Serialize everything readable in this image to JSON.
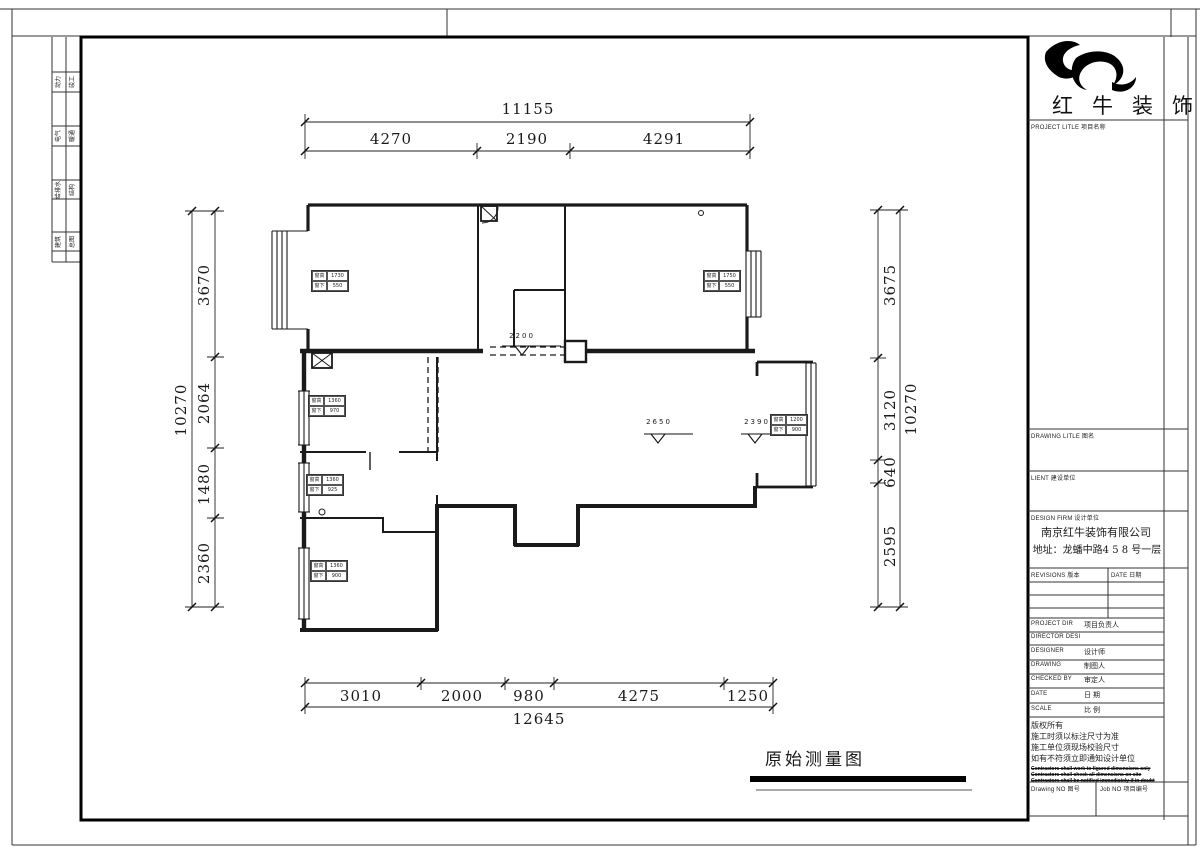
{
  "frame": {
    "fold_labels": [
      "动力",
      "竣工",
      "电气",
      "暖通",
      "给排水",
      "结构",
      "建筑",
      "总图"
    ],
    "drawing_caption": "原始测量图"
  },
  "plan": {
    "dims_top": {
      "total": "11155",
      "segments": [
        "4270",
        "2190",
        "4291"
      ]
    },
    "dims_left": {
      "total": "10270",
      "segments": [
        "3670",
        "2064",
        "1480",
        "2360"
      ]
    },
    "dims_right": {
      "total": "10270",
      "segments": [
        "3675",
        "3120",
        "640",
        "2595"
      ]
    },
    "dims_bottom": {
      "total": "12645",
      "segments": [
        "3010",
        "2000",
        "980",
        "4275",
        "1250"
      ]
    },
    "levels": [
      "2200",
      "2650",
      "2390"
    ],
    "tag_h_label": "窗高",
    "tag_s_label": "窗下",
    "window_tags": [
      {
        "h": "1730",
        "s": "550"
      },
      {
        "h": "1750",
        "s": "550"
      },
      {
        "h": "1360",
        "s": "970"
      },
      {
        "h": "1360",
        "s": "925"
      },
      {
        "h": "1360",
        "s": "900"
      },
      {
        "h": "1200",
        "s": "900"
      }
    ]
  },
  "titleblock": {
    "brand": "红牛装饰",
    "project_label": "PROJECT LITLE  项目名称",
    "drawing_label": "DRAWING LITLE  图名",
    "client_label": "LIENT  建设单位",
    "firm_label": "DESIGN FIRM  设计单位",
    "company": "南京红牛装饰有限公司",
    "address": "地址：龙蟠中路4 5 8 号一层",
    "revisions_label": "REVISIONS  版本",
    "date_col_label": "DATE  日期",
    "rows": [
      {
        "en": "PROJECT DIR",
        "cn": "项目负责人"
      },
      {
        "en": "DIRECTOR DESI",
        "cn": ""
      },
      {
        "en": "DESIGNER",
        "cn": "设计师"
      },
      {
        "en": "DRAWING",
        "cn": "制图人"
      },
      {
        "en": "CHECKED BY",
        "cn": "审定人"
      },
      {
        "en": "DATE",
        "cn": "日  期"
      },
      {
        "en": "SCALE",
        "cn": "比  例"
      }
    ],
    "notes_cn": [
      "版权所有",
      "施工时须以标注尺寸为准",
      "施工单位须现场校验尺寸",
      "如有不符须立即通知设计单位"
    ],
    "notes_en": [
      "Contractors shall work to figured dimensions only",
      "Contractors shall check all dimensions on site",
      "Contractors shall be notified immediately if in doubt"
    ],
    "drawing_no_label": "Drawing NO  图号",
    "job_no_label": "Job NO  项目编号"
  }
}
